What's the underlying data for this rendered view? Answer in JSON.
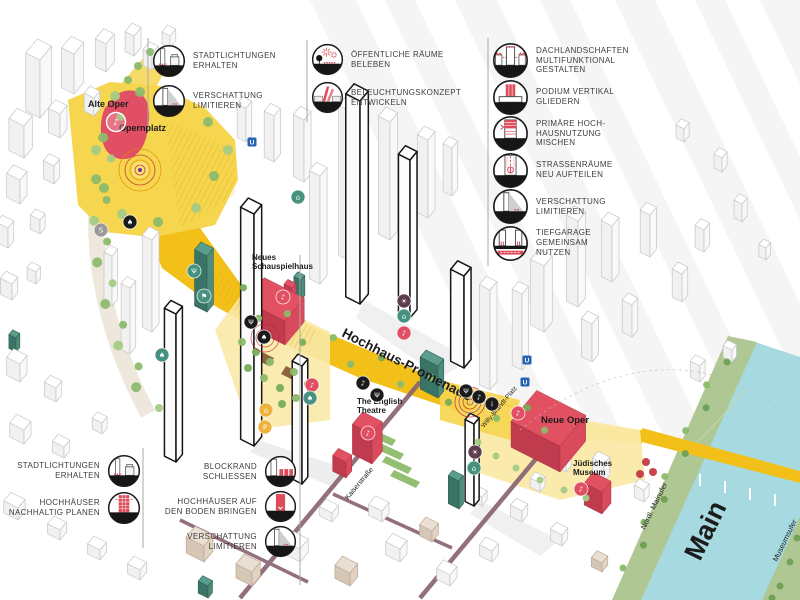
{
  "palette": {
    "promenade_yellow": "#F2C019",
    "plaza_yellow": "#F6D54F",
    "pale_yellow": "#FAE9A8",
    "hatch_yellow": "#DEA90E",
    "landmark_red": "#E04F63",
    "landmark_red_dark": "#C03B4D",
    "teal": "#46917F",
    "teal_dark": "#3A7466",
    "river_blue": "#A6D9E0",
    "bank_green": "#AFC793",
    "tree_green": "#8CBA6B",
    "tree_green_dark": "#6FA054",
    "street_mauve": "#8A6470",
    "outline_gray": "#C6C6C6",
    "outline_bold": "#161616",
    "badge_dark": "#1B1B1B",
    "badge_red": "#E04F63",
    "badge_yellow": "#EEB33C",
    "badge_brown": "#5E3D4D",
    "badge_gray": "#9A9A9A",
    "ubahn_blue": "#2365AE",
    "legend_text": "#3D3D3D"
  },
  "legend_groups": [
    {
      "id": "top-left",
      "items": [
        {
          "icon": "stadtlichtungen",
          "lines": [
            "STADTLICHTUNGEN",
            "ERHALTEN"
          ]
        },
        {
          "icon": "verschattung",
          "lines": [
            "VERSCHATTUNG",
            "LIMITIEREN"
          ]
        }
      ]
    },
    {
      "id": "top-middle",
      "items": [
        {
          "icon": "oeffentliche-raeume",
          "lines": [
            "ÖFFENTLICHE RÄUME",
            "BELEBEN"
          ]
        },
        {
          "icon": "beleuchtung",
          "lines": [
            "BELEUCHTUNGSKONZEPT",
            "ENTWICKELN"
          ]
        }
      ]
    },
    {
      "id": "top-right",
      "items": [
        {
          "icon": "dachlandschaften",
          "lines": [
            "DACHLANDSCHAFTEN",
            "MULTIFUNKTIONAL",
            "GESTALTEN"
          ]
        },
        {
          "icon": "podium",
          "lines": [
            "PODIUM VERTIKAL",
            "GLIEDERN"
          ]
        },
        {
          "icon": "hochhausnutzung",
          "lines": [
            "PRIMÄRE HOCH-",
            "HAUSNUTZUNG",
            "MISCHEN"
          ]
        },
        {
          "icon": "strassenraeume",
          "lines": [
            "STRASSENRÄUME",
            "NEU AUFTEILEN"
          ]
        },
        {
          "icon": "verschattung",
          "lines": [
            "VERSCHATTUNG",
            "LIMITIEREN"
          ]
        },
        {
          "icon": "tiefgarage",
          "lines": [
            "TIEFGARAGE",
            "GEMEINSAM",
            "NUTZEN"
          ]
        }
      ]
    },
    {
      "id": "bottom-left",
      "items": [
        {
          "icon": "stadtlichtungen",
          "lines": [
            "STADTLICHTUNGEN",
            "ERHALTEN"
          ]
        },
        {
          "icon": "nachhaltig",
          "lines": [
            "HOCHHÄUSER",
            "NACHHALTIG PLANEN"
          ]
        }
      ]
    },
    {
      "id": "bottom-middle",
      "items": [
        {
          "icon": "blockrand",
          "lines": [
            "BLOCKRAND",
            "SCHLIESSEN"
          ]
        },
        {
          "icon": "boden-bringen",
          "lines": [
            "HOCHHÄUSER AUF",
            "DEN BODEN BRINGEN"
          ]
        },
        {
          "icon": "verschattung",
          "lines": [
            "VERSCHATTUNG",
            "LIMITIEREN"
          ]
        }
      ]
    }
  ],
  "map_labels": [
    {
      "name": "alte-oper",
      "lines": [
        "Alte Oper"
      ],
      "x": 88,
      "y": 107,
      "size": 9,
      "weight": 700,
      "rot": 0
    },
    {
      "name": "opernplatz",
      "lines": [
        "Opernplatz"
      ],
      "x": 119,
      "y": 131,
      "size": 9,
      "weight": 700,
      "rot": 0
    },
    {
      "name": "neues-schauspielhaus",
      "lines": [
        "Neues",
        "Schauspielhaus"
      ],
      "x": 252,
      "y": 260,
      "size": 8,
      "weight": 700,
      "rot": 0
    },
    {
      "name": "hochhaus-promenade",
      "lines": [
        "Hochhaus-Promenade"
      ],
      "x": 341,
      "y": 336,
      "size": 13.5,
      "weight": 700,
      "rot": 27
    },
    {
      "name": "the-english-theatre",
      "lines": [
        "The English",
        "Theatre"
      ],
      "x": 357,
      "y": 404,
      "size": 8,
      "weight": 700,
      "rot": 0
    },
    {
      "name": "neue-oper",
      "lines": [
        "Neue Oper"
      ],
      "x": 541,
      "y": 423,
      "size": 9.5,
      "weight": 700,
      "rot": 0
    },
    {
      "name": "juedisches-museum",
      "lines": [
        "Jüdisches",
        "Museum"
      ],
      "x": 573,
      "y": 466,
      "size": 8,
      "weight": 700,
      "rot": 0
    },
    {
      "name": "willy-brandt-platz",
      "lines": [
        "Willy-Brandt-Platz"
      ],
      "x": 484,
      "y": 428,
      "size": 6.5,
      "weight": 400,
      "rot": -50
    },
    {
      "name": "kaiserstrasse",
      "lines": [
        "Kaiserstraße"
      ],
      "x": 348,
      "y": 500,
      "size": 7,
      "weight": 400,
      "rot": -50
    },
    {
      "name": "noerdl-mainufer",
      "lines": [
        "Nördl. Mainufer"
      ],
      "x": 645,
      "y": 530,
      "size": 7.5,
      "weight": 400,
      "rot": -64
    },
    {
      "name": "museumsufer",
      "lines": [
        "Museumsufer"
      ],
      "x": 777,
      "y": 562,
      "size": 7.5,
      "weight": 400,
      "rot": -64
    },
    {
      "name": "main-river",
      "lines": [
        "Main"
      ],
      "x": 700,
      "y": 562,
      "size": 27,
      "weight": 700,
      "rot": -64
    }
  ],
  "badges": [
    {
      "name": "tree-icon",
      "x": 130,
      "y": 222,
      "c": "dark",
      "g": "♠"
    },
    {
      "name": "sbahn-icon",
      "x": 101,
      "y": 230,
      "c": "gray",
      "g": "S"
    },
    {
      "name": "cafe-icon",
      "x": 194,
      "y": 271,
      "c": "teal",
      "g": "Ψ"
    },
    {
      "name": "flag-icon",
      "x": 204,
      "y": 296,
      "c": "teal",
      "g": "⚑"
    },
    {
      "name": "garden-icon",
      "x": 162,
      "y": 355,
      "c": "teal",
      "g": "♠"
    },
    {
      "name": "dining-icon",
      "x": 251,
      "y": 322,
      "c": "dark",
      "g": "Ψ"
    },
    {
      "name": "tree-icon",
      "x": 264,
      "y": 337,
      "c": "dark",
      "g": "♠"
    },
    {
      "name": "music-icon",
      "x": 283,
      "y": 297,
      "c": "red",
      "g": "♪"
    },
    {
      "name": "kiosk-icon",
      "x": 298,
      "y": 197,
      "c": "teal",
      "g": "⌂"
    },
    {
      "name": "lamp-icon",
      "x": 404,
      "y": 301,
      "c": "brown",
      "g": "☀"
    },
    {
      "name": "shop-icon",
      "x": 404,
      "y": 316,
      "c": "teal",
      "g": "⌂"
    },
    {
      "name": "music-icon",
      "x": 404,
      "y": 333,
      "c": "red",
      "g": "♪"
    },
    {
      "name": "music-icon",
      "x": 312,
      "y": 385,
      "c": "red",
      "g": "♪"
    },
    {
      "name": "garden-icon",
      "x": 310,
      "y": 398,
      "c": "teal",
      "g": "♠"
    },
    {
      "name": "market-icon",
      "x": 266,
      "y": 410,
      "c": "yellow",
      "g": "⌂"
    },
    {
      "name": "parking-icon",
      "x": 265,
      "y": 427,
      "c": "yellow",
      "g": "P"
    },
    {
      "name": "music-icon",
      "x": 363,
      "y": 383,
      "c": "dark",
      "g": "♪"
    },
    {
      "name": "dining-icon",
      "x": 377,
      "y": 395,
      "c": "dark",
      "g": "Ψ"
    },
    {
      "name": "music-icon",
      "x": 368,
      "y": 433,
      "c": "red",
      "g": "♪"
    },
    {
      "name": "dining-icon",
      "x": 466,
      "y": 391,
      "c": "dark",
      "g": "Ψ"
    },
    {
      "name": "music-icon",
      "x": 479,
      "y": 397,
      "c": "dark",
      "g": "♪"
    },
    {
      "name": "info-icon",
      "x": 492,
      "y": 404,
      "c": "dark",
      "g": "i"
    },
    {
      "name": "music-icon",
      "x": 518,
      "y": 413,
      "c": "red",
      "g": "♪"
    },
    {
      "name": "lamp-icon",
      "x": 475,
      "y": 452,
      "c": "brown",
      "g": "☀"
    },
    {
      "name": "shop-icon",
      "x": 474,
      "y": 468,
      "c": "teal",
      "g": "⌂"
    },
    {
      "name": "music-icon",
      "x": 581,
      "y": 489,
      "c": "red",
      "g": "♪"
    },
    {
      "name": "music-icon",
      "x": 116,
      "y": 122,
      "c": "outline",
      "g": "♪"
    }
  ],
  "transit_markers": {
    "u_label": "U",
    "u": [
      {
        "x": 252,
        "y": 142
      },
      {
        "x": 527,
        "y": 360
      },
      {
        "x": 525,
        "y": 382
      }
    ]
  }
}
